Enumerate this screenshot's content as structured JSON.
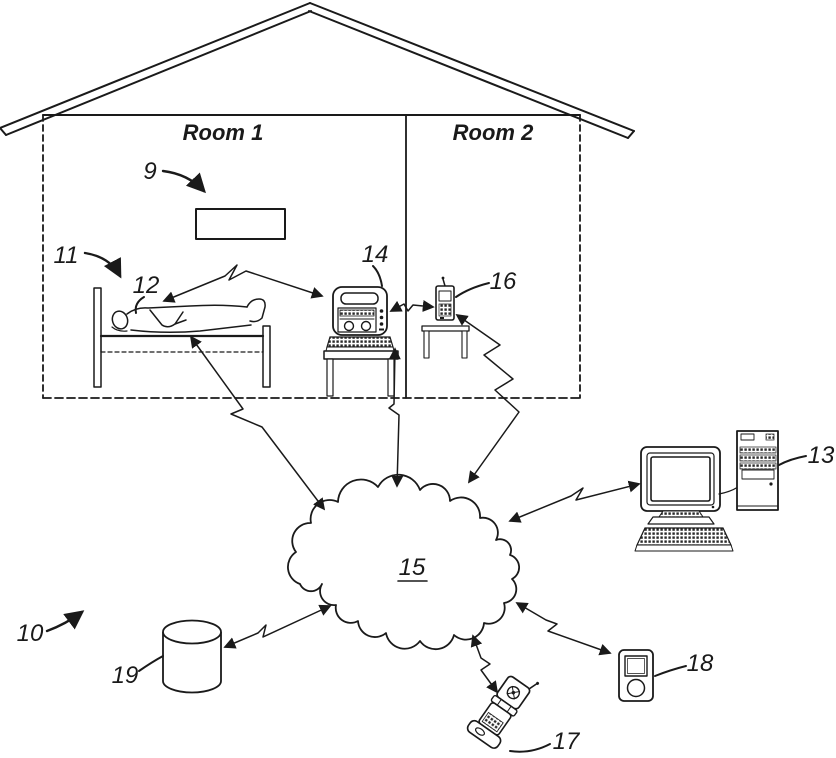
{
  "figure": {
    "rooms": {
      "room1": "Room 1",
      "room2": "Room 2"
    },
    "labels": {
      "wall_display": "9",
      "system": "10",
      "house": "11",
      "patient": "12",
      "remote_computer": "13",
      "monitoring_device": "14",
      "network": "15",
      "handheld_device": "16",
      "mobile_phone": "17",
      "media_player": "18",
      "database": "19"
    },
    "colors": {
      "line": "#1a1a1a",
      "background": "#ffffff"
    },
    "links": [
      {
        "from": "12",
        "to": "14",
        "style": "wireless"
      },
      {
        "from": "14",
        "to": "16",
        "style": "wireless"
      },
      {
        "from": "12",
        "to": "15",
        "style": "wireless"
      },
      {
        "from": "14",
        "to": "15",
        "style": "wireless"
      },
      {
        "from": "16",
        "to": "15",
        "style": "wireless"
      },
      {
        "from": "15",
        "to": "13",
        "style": "wireless"
      },
      {
        "from": "15",
        "to": "19",
        "style": "wireless"
      },
      {
        "from": "15",
        "to": "17",
        "style": "wireless"
      },
      {
        "from": "15",
        "to": "18",
        "style": "wireless"
      }
    ]
  }
}
